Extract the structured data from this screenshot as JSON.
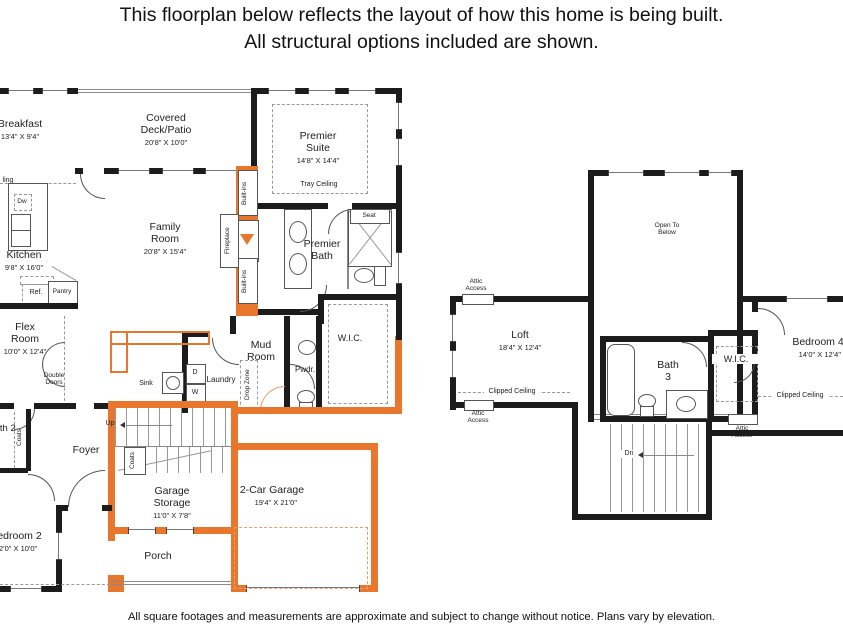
{
  "title": {
    "line1": "This floorplan below reflects the layout of how this home is being built.",
    "line2": "All structural options included are shown."
  },
  "footer": {
    "disclaimer": "All square footages and measurements are approximate and subject to change without notice. Plans vary by elevation."
  },
  "colors": {
    "accent_orange": "#E8762C",
    "wall_black": "#1C1C1C"
  },
  "first_floor": {
    "breakfast": {
      "name": "Breakfast",
      "dims": "13'4\" X 9'4\""
    },
    "deck": {
      "name": "Covered Deck/Patio",
      "dims": "20'8\" X 10'0\""
    },
    "premier_suite": {
      "name": "Premier Suite",
      "dims": "14'8\" X 14'4\""
    },
    "family_room": {
      "name": "Family Room",
      "dims": "20'8\" X 15'4\""
    },
    "kitchen": {
      "name": "Kitchen",
      "dims": "9'8\" X 16'0\""
    },
    "flex_room": {
      "name": "Flex Room",
      "dims": "10'0\" X 12'4\""
    },
    "mud_room": {
      "name": "Mud Room"
    },
    "premier_bath": {
      "name": "Premier Bath"
    },
    "wic": {
      "name": "W.I.C."
    },
    "pwdr": {
      "name": "Pwdr."
    },
    "laundry": {
      "name": "Laundry"
    },
    "foyer": {
      "name": "Foyer"
    },
    "bath2": {
      "name": "Bath 2"
    },
    "bedroom2": {
      "name": "Bedroom 2",
      "dims": "12'0\" X 10'0\""
    },
    "garage_storage": {
      "name": "Garage Storage",
      "dims": "11'0\" X 7'8\""
    },
    "garage": {
      "name": "2-Car Garage",
      "dims": "19'4\" X 21'0\""
    },
    "porch": {
      "name": "Porch"
    },
    "annotations": {
      "tray_ceiling": "Tray Ceiling",
      "built_ins": "Built-ins",
      "fireplace": "Fireplace",
      "seat": "Seat",
      "dw": "Dw",
      "ref": "Ref.",
      "pantry": "Pantry",
      "double_doors": "Double Doors",
      "sink": "Sink",
      "drop_zone": "Drop Zone",
      "dryer": "D",
      "washer": "W",
      "up": "Up",
      "coats": "Coats",
      "ceiling_partial": "ling"
    }
  },
  "second_floor": {
    "loft": {
      "name": "Loft",
      "dims": "18'4\" X 12'4\""
    },
    "open_to_below": {
      "name": "Open To Below"
    },
    "bath3": {
      "name": "Bath 3"
    },
    "wic": {
      "name": "W.I.C."
    },
    "bedroom4": {
      "name": "Bedroom 4",
      "dims": "14'0\" X 12'4\""
    },
    "annotations": {
      "attic_access": "Attic Access",
      "clipped_ceiling": "Clipped Ceiling",
      "dn": "Dn"
    }
  }
}
